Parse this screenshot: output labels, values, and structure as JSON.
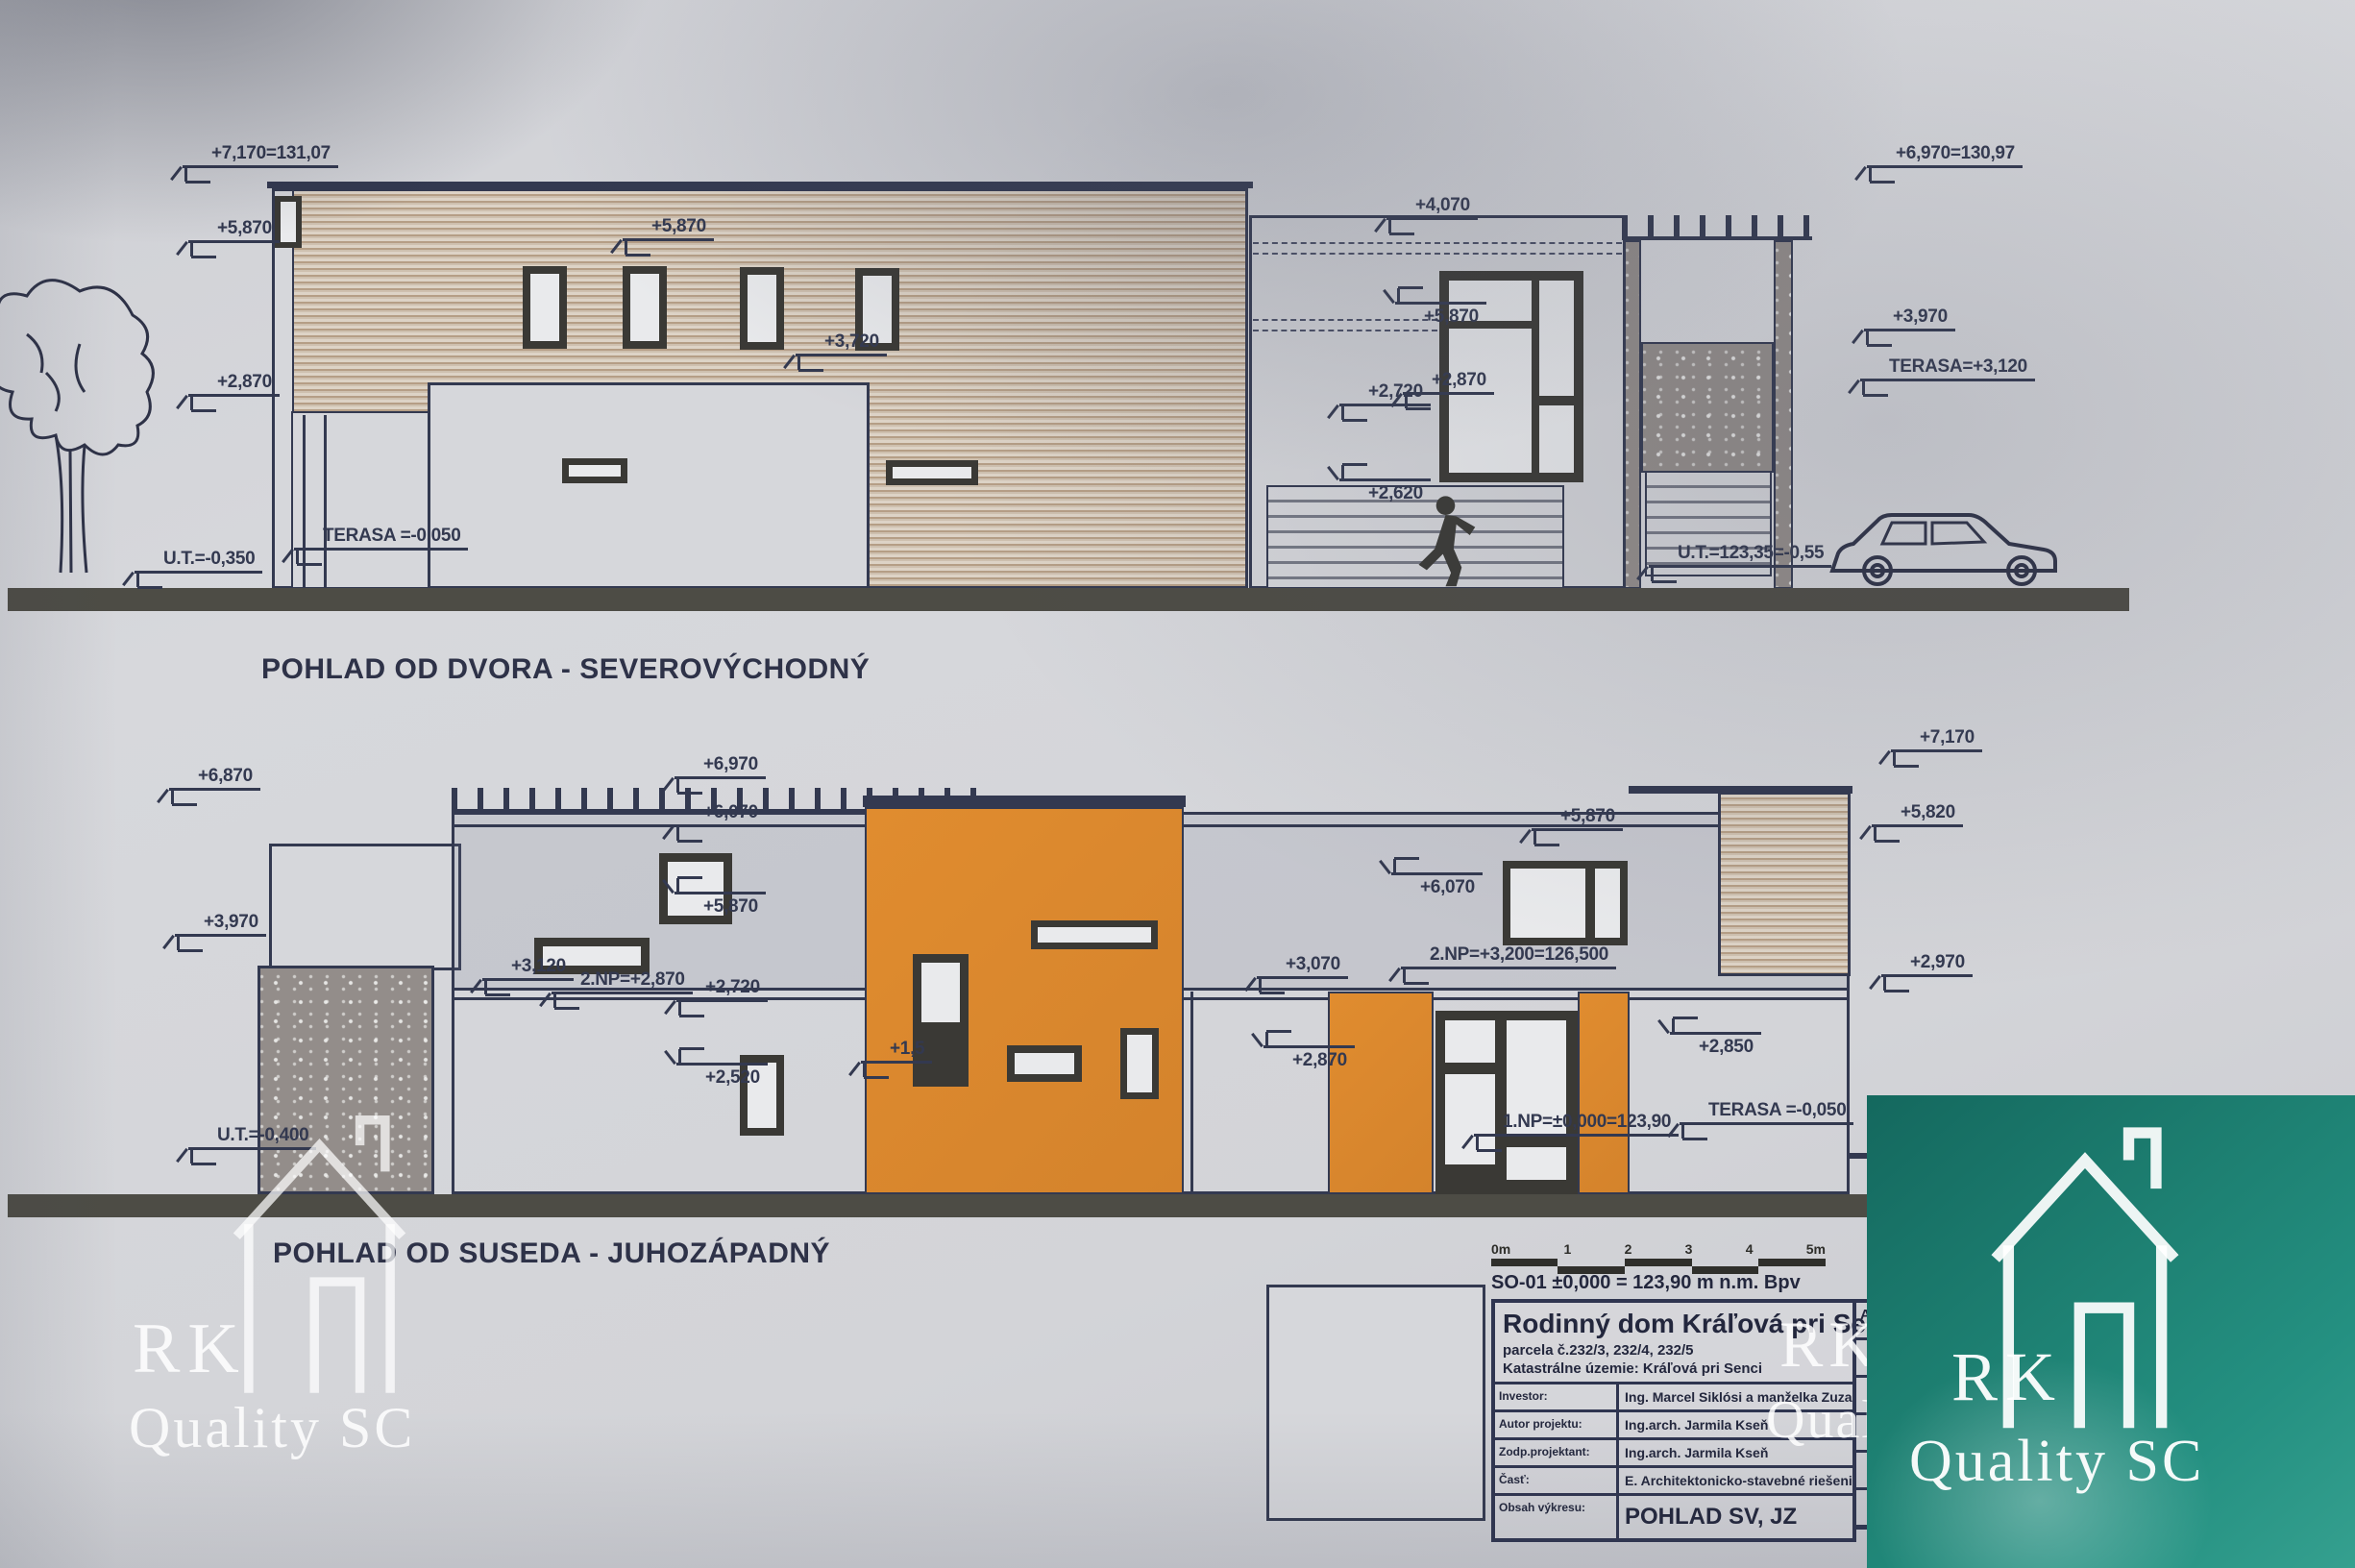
{
  "photo": {
    "paper_color": "#d5d6da",
    "ink_color": "#333950",
    "orange_color": "#dd8a33",
    "teal_color": "#1f8476",
    "wood_light": "#ddd3c6",
    "wood_dark": "#b59e86"
  },
  "view1": {
    "title": "POHLAD OD DVORA - SEVEROVÝCHODNÝ"
  },
  "view2": {
    "title": "POHLAD OD SUSEDA - JUHOZÁPADNÝ"
  },
  "markers1": [
    "+7,170=131,07",
    "+5,870",
    "+2,870",
    "U.T.=-0,350",
    "TERASA =-0,050",
    "+5,870",
    "+3,720",
    "+4,070",
    "+5,870",
    "+2,870",
    "+2,720",
    "+2,620",
    "+6,970=130,97",
    "+3,970",
    "TERASA=+3,120",
    "U.T.=123,35=-0,55"
  ],
  "markers2": [
    "+6,870",
    "+3,970",
    "U.T.=-0,400",
    "+6,970",
    "+6,070",
    "+5,870",
    "+3,120",
    "2.NP=+2,870",
    "+2,720",
    "+2,520",
    "+1,5",
    "+3,070",
    "+2,870",
    "2.NP=+3,200=126,500",
    "+6,070",
    "+5,870",
    "+7,170",
    "+5,820",
    "+2,970",
    "+2,850",
    "TERASA =-0,050",
    "1.NP=±0,000=123,90"
  ],
  "scalebar": {
    "labels": [
      "0m",
      "1",
      "2",
      "3",
      "4",
      "5m"
    ]
  },
  "titleblock": {
    "datum_line": "SO-01 ±0,000 = 123,90 m n.m. Bpv",
    "project": "Rodinný dom Kráľová pri Senci",
    "parcel": "parcela č.232/3, 232/4, 232/5",
    "cadastre": "Katastrálne územie: Kráľová pri Senci",
    "rows": [
      {
        "label": "Investor:",
        "value": "Ing. Marcel Siklósi a manželka Zuzana S."
      },
      {
        "label": "Autor projektu:",
        "value": "Ing.arch. Jarmila Kseň"
      },
      {
        "label": "Zodp.projektant:",
        "value": "Ing.arch. Jarmila Kseň"
      },
      {
        "label": "Časť:",
        "value": "E. Architektonicko-stavebné riešenie"
      },
      {
        "label": "Obsah výkresu:",
        "value": "POHLAD SV, JZ"
      }
    ],
    "side_letter": "A"
  },
  "watermark": {
    "line1": "RK",
    "line2": "Quality SC"
  }
}
